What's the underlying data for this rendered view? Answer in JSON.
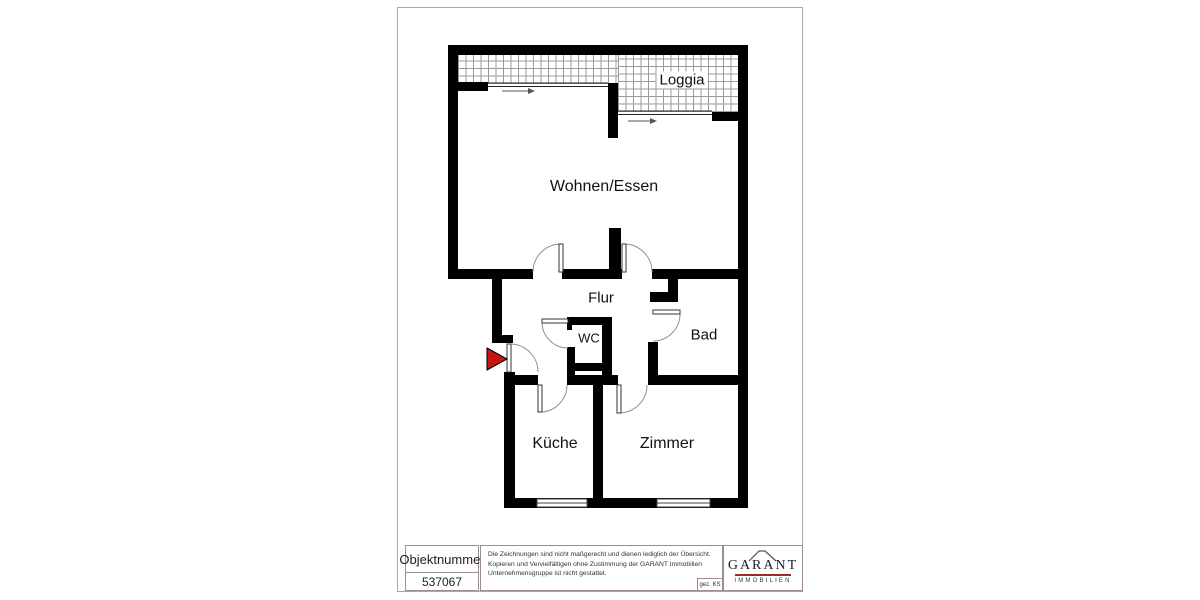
{
  "floorplan": {
    "rooms": [
      {
        "label": "Loggia"
      },
      {
        "label": "Wohnen/Essen"
      },
      {
        "label": "Flur"
      },
      {
        "label": "WC"
      },
      {
        "label": "Bad"
      },
      {
        "label": "Küche"
      },
      {
        "label": "Zimmer"
      }
    ],
    "colors": {
      "wall": "#000000",
      "entrance_marker": "#c41414",
      "hatch_line": "#9a9a9a",
      "page_border": "#b3a2a2"
    }
  },
  "title_block": {
    "object_number_label": "Objektnummer",
    "object_number_value": "537067",
    "disclaimer_lines": [
      "Die Zeichnungen sind nicht maßgerecht und dienen lediglich der Übersicht.",
      "Kopieren und Vervielfältigen ohne Zustimmung der GARANT Immobilien",
      "Unternehmensgruppe ist nicht gestattet."
    ],
    "signed": "gez. KS",
    "logo": {
      "wordmark": "GARANT",
      "subtitle": "IMMOBILIEN",
      "underline_color": "#9e2b25"
    }
  }
}
